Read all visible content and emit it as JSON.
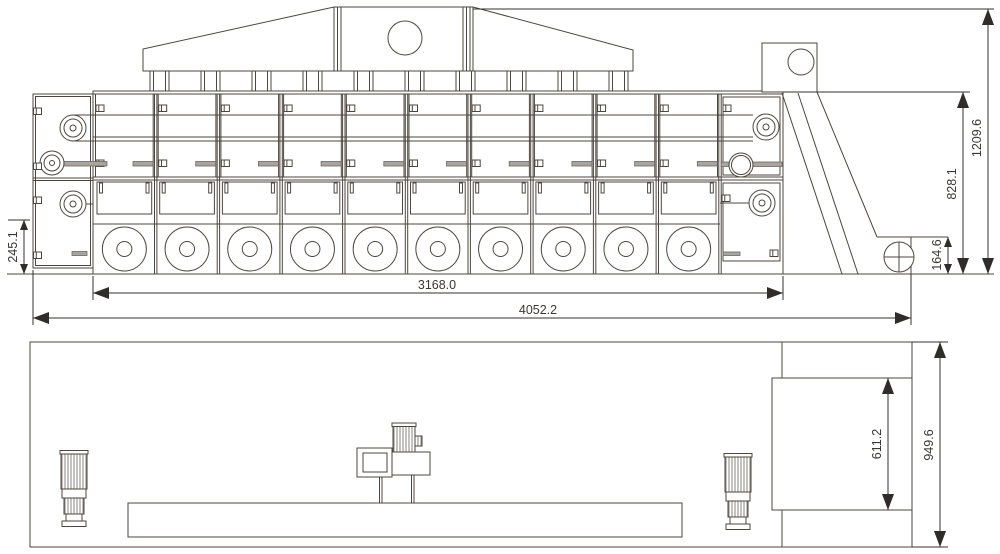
{
  "drawing": {
    "kind": "belt-dryer-technical-drawing",
    "side_view": {
      "dims": {
        "body_length": "3168.0",
        "overall_length": "4052.2",
        "inlet_height": "245.1",
        "discharge_height": "164.6",
        "body_height": "828.1",
        "overall_height": "1209.6"
      }
    },
    "plan_view": {
      "dims": {
        "elevator_length": "611.2",
        "overall_width": "949.6"
      }
    },
    "colors": {
      "line": "#4e463e",
      "dimension": "#35322f",
      "gray_fill": "#a9a49f",
      "background": "#ffffff"
    }
  }
}
